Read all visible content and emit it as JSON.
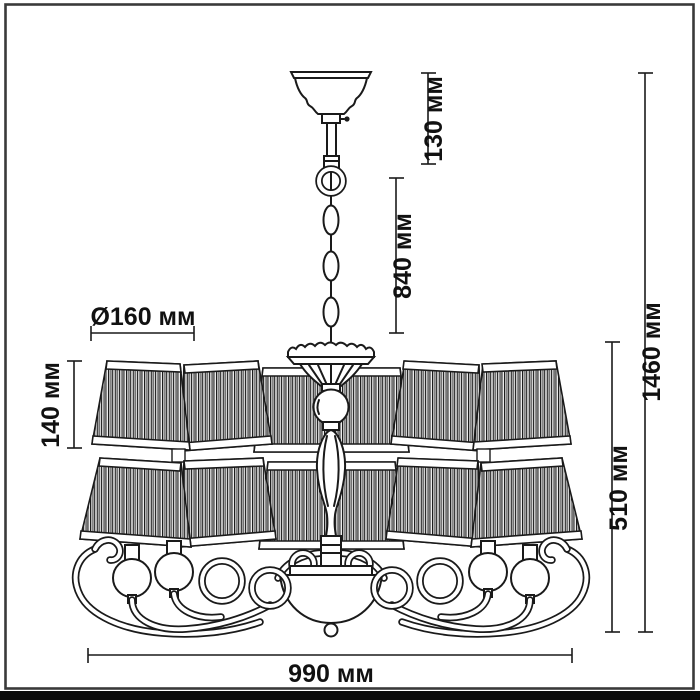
{
  "drawing_type": "chandelier-dimension-diagram",
  "dimensions": {
    "canopy_height": "130 мм",
    "chain_drop": "840 мм",
    "total_height": "1460 мм",
    "fixture_height": "510 мм",
    "shade_diameter": "Ø160 мм",
    "shade_height": "140 мм",
    "fixture_width": "990 мм"
  },
  "colors": {
    "line": "#1a1a1a",
    "frame": "#3a3a3a",
    "background": "#ffffff",
    "bottom_bar": "#0b0b0b"
  }
}
